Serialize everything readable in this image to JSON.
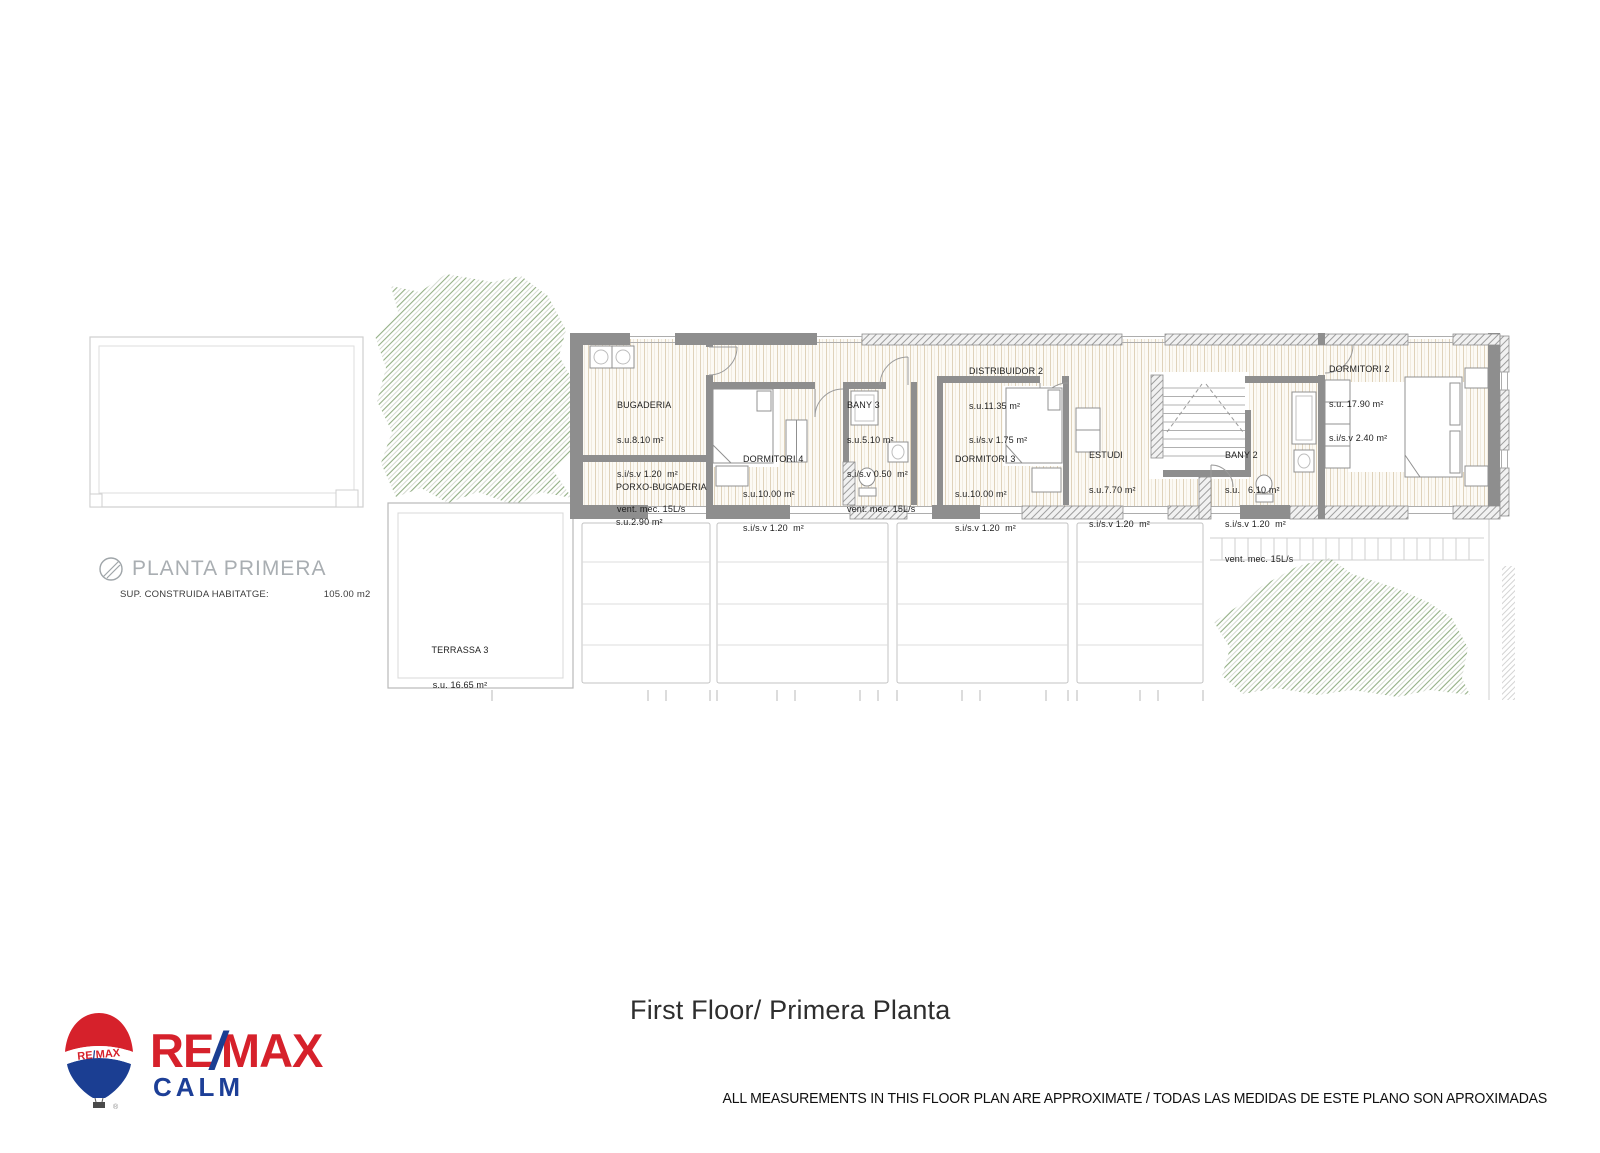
{
  "page": {
    "title": "First Floor/ Primera Planta",
    "disclaimer": "ALL MEASUREMENTS IN THIS FLOOR PLAN ARE APPROXIMATE / TODAS LAS MEDIDAS DE ESTE PLANO SON APROXIMADAS"
  },
  "logo": {
    "re": "RE",
    "slash": "/",
    "max": "MAX",
    "office": "CALM",
    "balloon_re": "RE",
    "balloon_slash": "/",
    "balloon_max": "MAX",
    "registered": "®",
    "colors": {
      "red": "#d6212b",
      "blue": "#1b3e92"
    }
  },
  "plan": {
    "name_label": "PLANTA PRIMERA",
    "built_area_label": "SUP. CONSTRUIDA HABITATGE:",
    "built_area_value": "105.00 m2",
    "rooms": [
      {
        "name": "BUGADERIA",
        "lines": [
          "s.u.8.10 m²",
          "s.i/s.v 1.20  m²",
          "vent. mec. 15L/s"
        ]
      },
      {
        "name": "PORXO-BUGADERIA",
        "lines": [
          "s.u.2.90 m²"
        ]
      },
      {
        "name": "DORMITORI 4",
        "lines": [
          "s.u.10.00 m²",
          "s.i/s.v 1.20  m²"
        ]
      },
      {
        "name": "BANY 3",
        "lines": [
          "s.u.5.10 m²",
          "s.i/s.v 0.50  m²",
          "vent. mec. 15L/s"
        ]
      },
      {
        "name": "DISTRIBUIDOR 2",
        "lines": [
          "s.u.11.35 m²",
          "s.i/s.v 1.75 m²"
        ]
      },
      {
        "name": "DORMITORI 3",
        "lines": [
          "s.u.10.00 m²",
          "s.i/s.v 1.20  m²"
        ]
      },
      {
        "name": "ESTUDI",
        "lines": [
          "s.u.7.70 m²",
          "s.i/s.v 1.20  m²"
        ]
      },
      {
        "name": "BANY 2",
        "lines": [
          "s.u.   6.10 m²",
          "s.i/s.v 1.20  m²",
          "vent. mec. 15L/s"
        ]
      },
      {
        "name": "DORMITORI 2",
        "lines": [
          "s.u. 17.90 m²",
          "s.i/s.v 2.40 m²"
        ]
      },
      {
        "name": "TERRASSA 3",
        "lines": [
          "s.u. 16.65 m²"
        ]
      }
    ]
  }
}
